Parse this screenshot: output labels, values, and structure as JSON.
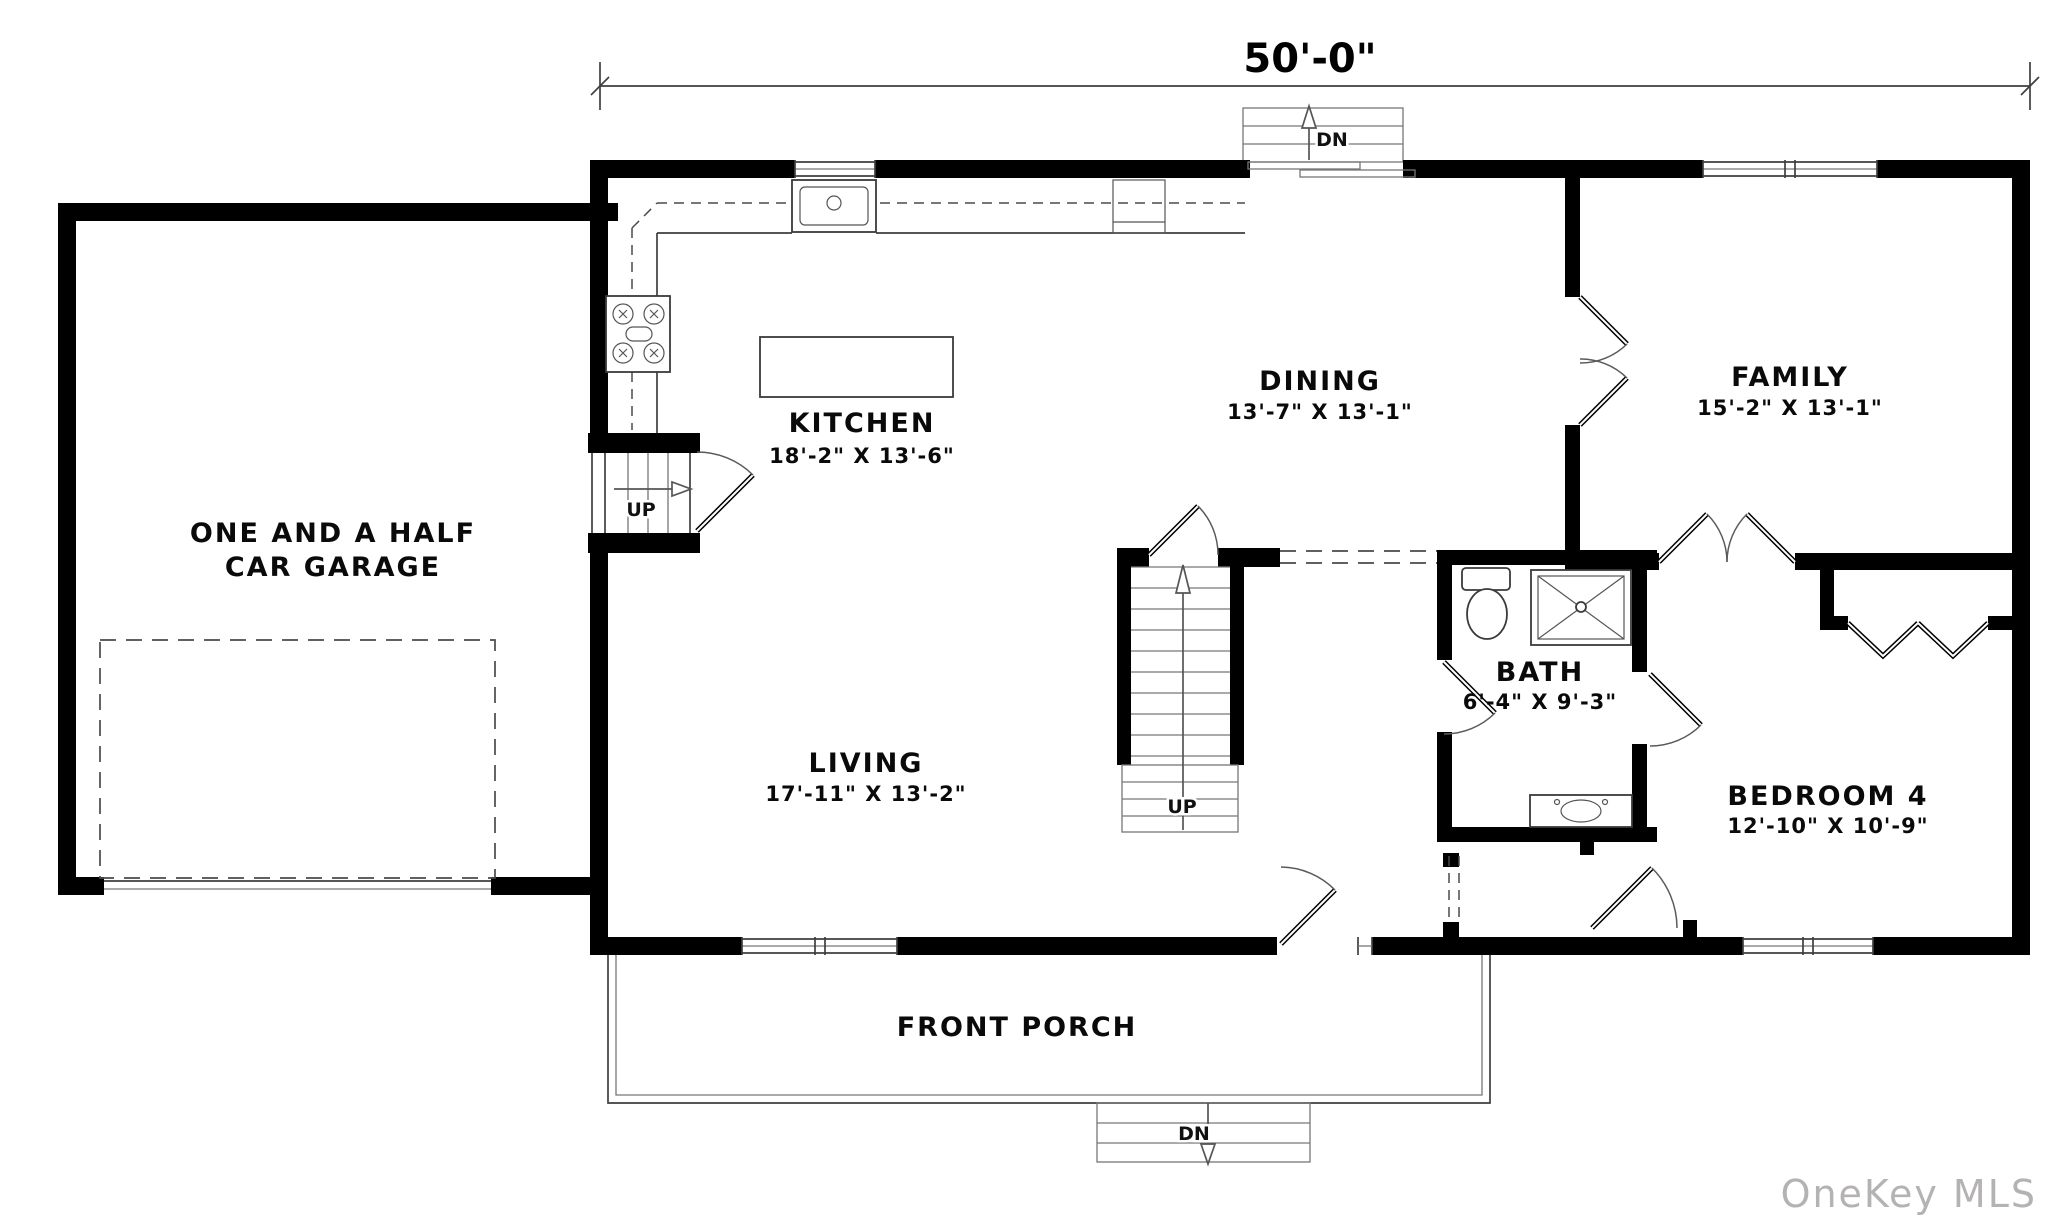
{
  "dimension": {
    "width_label": "50'-0\""
  },
  "rooms": {
    "kitchen": {
      "name": "KITCHEN",
      "dims": "18'-2\" X 13'-6\""
    },
    "dining": {
      "name": "DINING",
      "dims": "13'-7\" X 13'-1\""
    },
    "family": {
      "name": "FAMILY",
      "dims": "15'-2\" X 13'-1\""
    },
    "living": {
      "name": "LIVING",
      "dims": "17'-11\" X 13'-2\""
    },
    "bath": {
      "name": "BATH",
      "dims": "6'-4\" X 9'-3\""
    },
    "bedroom4": {
      "name": "BEDROOM 4",
      "dims": "12'-10\" X 10'-9\""
    },
    "garage": {
      "line1": "ONE AND A HALF",
      "line2": "CAR GARAGE"
    },
    "porch": {
      "name": "FRONT PORCH"
    }
  },
  "stairs": {
    "up_main": "UP",
    "up_garage": "UP",
    "dn_back": "DN",
    "dn_front": "DN"
  },
  "watermark": "OneKey MLS",
  "colors": {
    "wall": "#000000",
    "line": "#4a4a4a",
    "watermark": "#b5b2b2",
    "background": "#ffffff"
  }
}
